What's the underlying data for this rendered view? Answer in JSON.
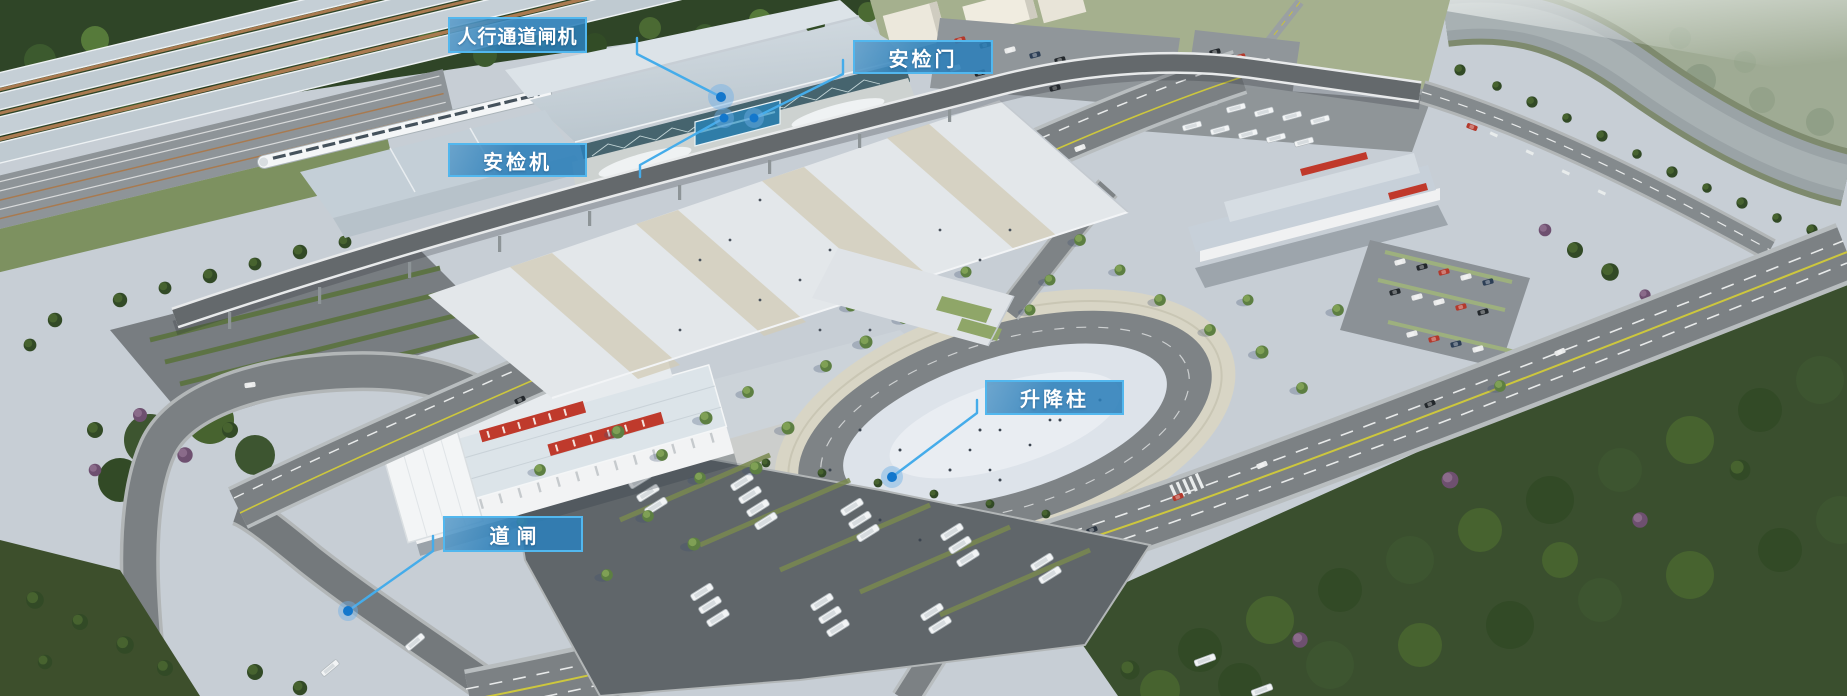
{
  "callouts": [
    {
      "id": "pedestrian-turnstile",
      "label": "人行通道闸机",
      "box": {
        "x": 448,
        "y": 17,
        "w": 139,
        "h": 36
      },
      "dot": {
        "x": 721,
        "y": 97
      }
    },
    {
      "id": "security-door",
      "label": "安检门",
      "box": {
        "x": 853,
        "y": 40,
        "w": 140,
        "h": 34
      },
      "dot": {
        "x": 754,
        "y": 118
      }
    },
    {
      "id": "security-scanner",
      "label": "安检机",
      "box": {
        "x": 448,
        "y": 143,
        "w": 139,
        "h": 34
      },
      "dot": {
        "x": 724,
        "y": 118
      }
    },
    {
      "id": "lifting-bollard",
      "label": "升降柱",
      "box": {
        "x": 985,
        "y": 380,
        "w": 139,
        "h": 35
      },
      "dot": {
        "x": 892,
        "y": 477
      }
    },
    {
      "id": "road-barrier",
      "label": "道闸",
      "box": {
        "x": 443,
        "y": 516,
        "w": 140,
        "h": 36
      },
      "dot": {
        "x": 348,
        "y": 611
      }
    }
  ],
  "style": {
    "callout_fill": "rgba(44,128,185,0.88)",
    "callout_border": "#52b7ee",
    "callout_text": "#ffffff",
    "leader_line": "#45acea",
    "dot_fill": "#1377cc",
    "dot_halo": "rgba(110,175,230,0.45)"
  }
}
